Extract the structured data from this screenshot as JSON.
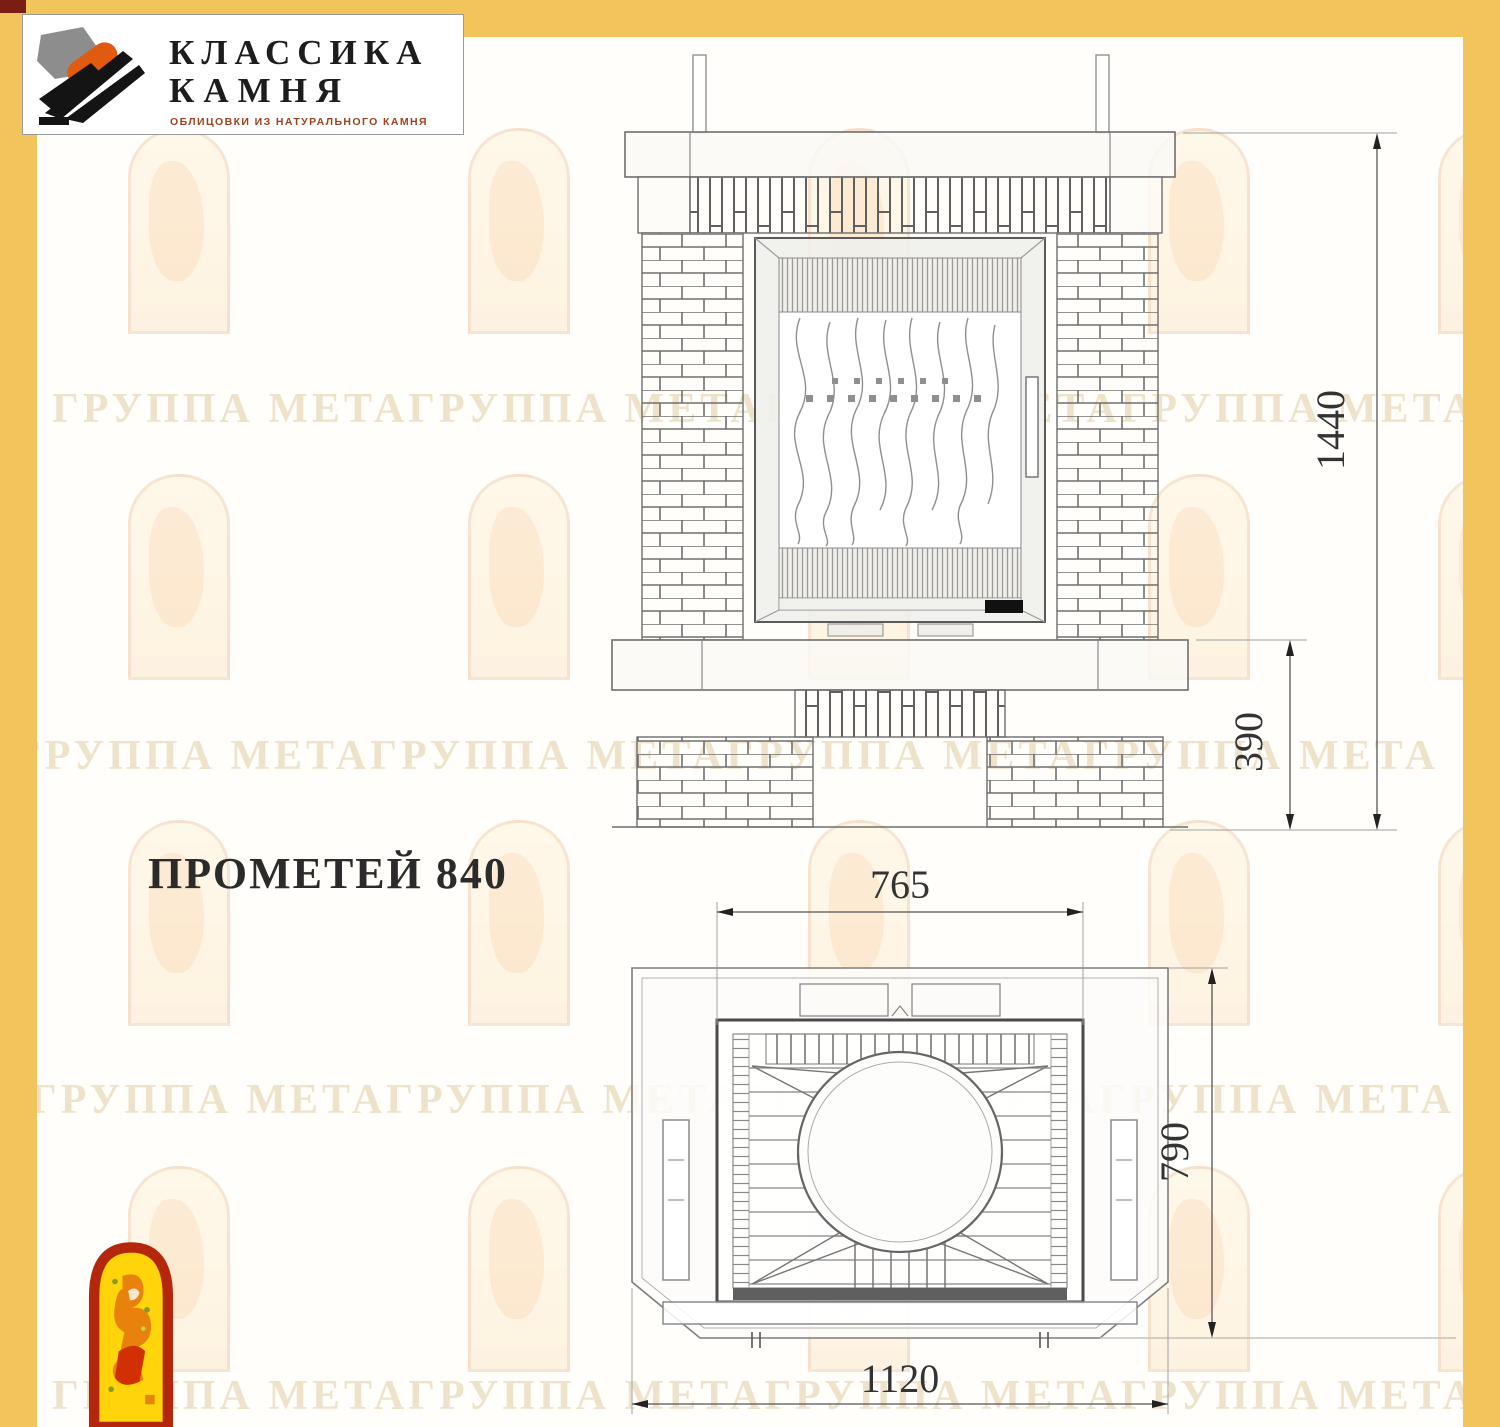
{
  "logo": {
    "title_line1": "КЛАССИКА",
    "title_line2": "КАМНЯ",
    "subtitle": "ОБЛИЦОВКИ ИЗ НАТУРАЛЬНОГО КАМНЯ"
  },
  "product": {
    "title": "ПРОМЕТЕЙ 840"
  },
  "front_view": {
    "dim_total_height": "1440",
    "dim_base_height": "390"
  },
  "plan_view": {
    "dim_insert_width": "765",
    "dim_depth": "790",
    "dim_total_width": "1120"
  },
  "watermark": {
    "row_text": "ГРУППА МЕТАГРУППА МЕТАГРУППА МЕТАГРУППА МЕТА"
  },
  "colors": {
    "frame_yellow": "#f2c45c",
    "logo_orange": "#e05a10",
    "logo_dark": "#111111",
    "subtitle_brown": "#99421f",
    "emblem_red": "#b5270d",
    "emblem_yellow": "#ffd40a",
    "drawing_line": "#6e6e6e",
    "dim_text": "#333333",
    "watermark_tint": "#efe2cb"
  }
}
